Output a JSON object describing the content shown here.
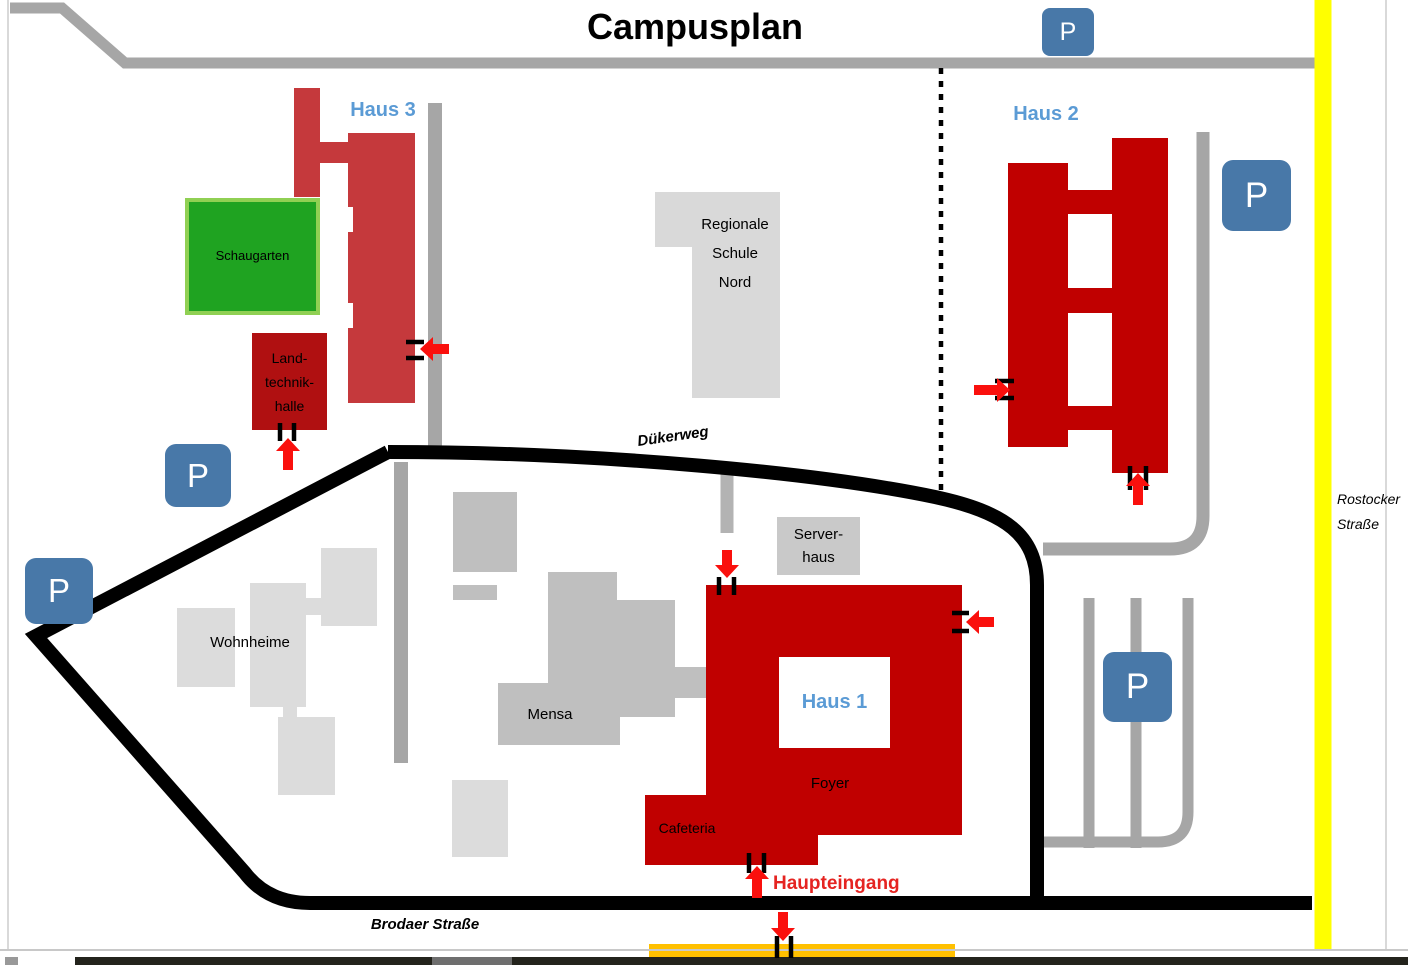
{
  "title": "Campusplan",
  "parking": {
    "label": "P"
  },
  "roads": {
    "duekerweg": "Dükerweg",
    "brodaer_strasse": "Brodaer Straße",
    "rostocker": [
      "Rostocker",
      "Straße"
    ]
  },
  "buildings": {
    "haus1": {
      "label": "Haus 1",
      "foyer": "Foyer",
      "cafeteria": "Cafeteria"
    },
    "haus2": {
      "label": "Haus 2"
    },
    "haus3": {
      "label": "Haus 3"
    },
    "schaugarten": {
      "label": "Schaugarten"
    },
    "landtechnikhalle": {
      "lines": [
        "Land-",
        "technik-",
        "halle"
      ]
    },
    "regionale_schule": {
      "lines": [
        "Regionale",
        "Schule",
        "Nord"
      ]
    },
    "wohnheime": {
      "label": "Wohnheime"
    },
    "mensa": {
      "label": "Mensa"
    },
    "serverhaus": {
      "lines": [
        "Server-",
        "haus"
      ]
    }
  },
  "entrances": {
    "haupteingang": "Haupteingang"
  },
  "colors": {
    "building_dark_red": "#C00000",
    "haus3_red": "#C5393C",
    "landtechnik_red": "#B01011",
    "garden_green": "#1FA321",
    "garden_border_green": "#90D053",
    "parking_blue": "#4878A8",
    "building_label_blue": "#5B9BD5",
    "road_gray": "#A6A6A6",
    "building_gray_light": "#DCDCDC",
    "building_gray_mid": "#BFBFBF",
    "street_yellow": "#FFFF00",
    "bus_stop_orange": "#FFC000",
    "arrow_red": "#FA100D"
  }
}
